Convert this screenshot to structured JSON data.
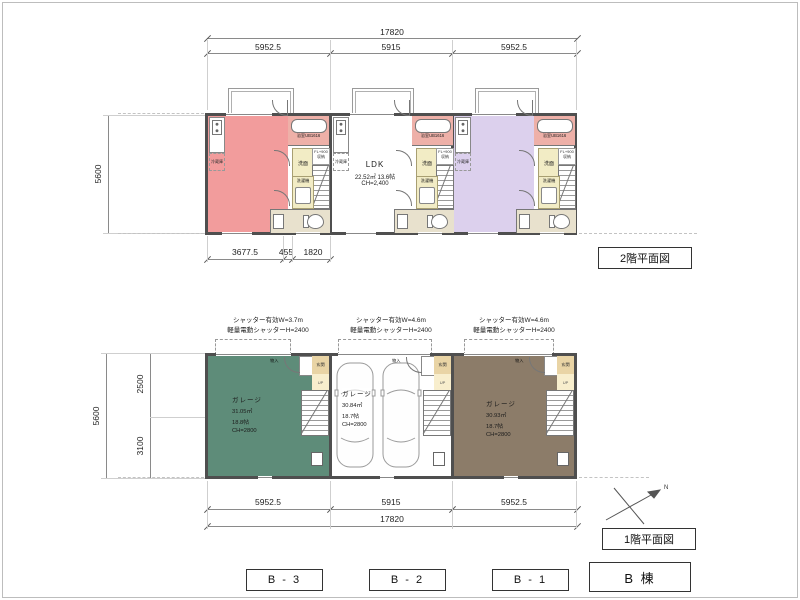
{
  "floor2": {
    "title": "2階平面図",
    "dim_total_top": "17820",
    "dim_segs_top": [
      "5952.5",
      "5915",
      "5952.5"
    ],
    "dim_left": "5600",
    "dims_bottom": [
      "3677.5",
      "455",
      "1820"
    ],
    "ldk": {
      "name": "LDK",
      "area": "22.52㎡ 13.6帖",
      "ceiling": "CH=2,400"
    },
    "labels": {
      "bath": "浴室UB1616",
      "wash": "洗面",
      "storage_l1": "FL+900",
      "storage_l2": "収納",
      "fridge": "冷蔵庫",
      "laundry": "洗濯機",
      "down": "DN"
    }
  },
  "floor1": {
    "title": "1階平面図",
    "shutter_notes": [
      {
        "l1": "シャッター有効W=3.7m",
        "l2": "軽量電動シャッターH=2400"
      },
      {
        "l1": "シャッター有効W=4.6m",
        "l2": "軽量電動シャッターH=2400"
      },
      {
        "l1": "シャッター有効W=4.6m",
        "l2": "軽量電動シャッターH=2400"
      }
    ],
    "garages": [
      {
        "name": "ガレージ",
        "area": "31.05㎡",
        "tatami": "18.8帖",
        "ceiling": "CH=2800"
      },
      {
        "name": "ガレージ",
        "area": "30.84㎡",
        "tatami": "18.7帖",
        "ceiling": "CH=2800"
      },
      {
        "name": "ガレージ",
        "area": "30.93㎡",
        "tatami": "18.7帖",
        "ceiling": "CH=2800"
      }
    ],
    "labels": {
      "entrance": "玄関",
      "up": "UP",
      "closet": "物入",
      "north": "N"
    },
    "dim_segs_bottom": [
      "5952.5",
      "5915",
      "5952.5"
    ],
    "dim_total_bottom": "17820",
    "dim_left": "5600",
    "dims_left_inner": [
      "2500",
      "3100"
    ]
  },
  "footer": {
    "unit_tags": [
      "B - 3",
      "B - 2",
      "B - 1"
    ],
    "building_tag": "B 棟"
  },
  "colors": {
    "wall": "#4f4f4f",
    "room_pink": "#f29c9c",
    "room_white": "#ffffff",
    "room_purple": "#dcd0ed",
    "bath_pink": "#eeb0a8",
    "cream": "#f2ecc5",
    "entrance_tan": "#e9d4a5",
    "landing_cream": "#f8eecd",
    "wc_beige": "#e8e1cd",
    "garage_green": "#5e8c79",
    "garage_white": "#ffffff",
    "garage_brown": "#8c7c69"
  }
}
